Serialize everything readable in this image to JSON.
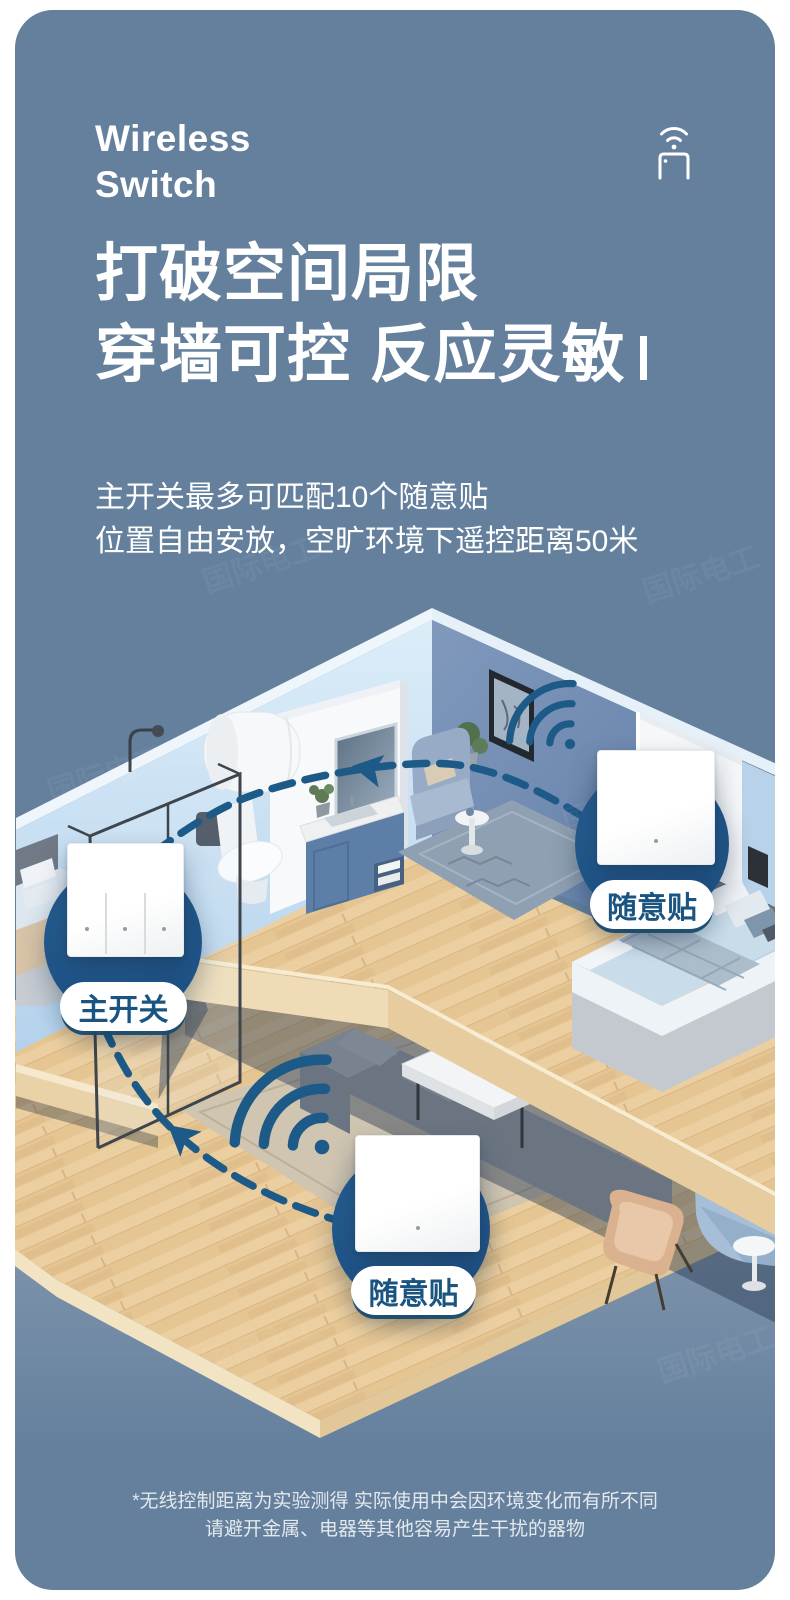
{
  "header": {
    "brand_line1": "Wireless",
    "brand_line2": "Switch"
  },
  "hero": {
    "title_line1": "打破空间局限",
    "title_line2": "穿墙可控 反应灵敏",
    "subtitle_line1": "主开关最多可匹配10个随意贴",
    "subtitle_line2": "位置自由安放，空旷环境下遥控距离50米"
  },
  "diagram": {
    "callouts": [
      {
        "id": "main-switch",
        "label": "主开关",
        "gangs": 3
      },
      {
        "id": "sticker-right",
        "label": "随意贴",
        "gangs": 1
      },
      {
        "id": "sticker-bottom",
        "label": "随意贴",
        "gangs": 1
      }
    ]
  },
  "footnote": {
    "line1": "*无线控制距离为实验测得 实际使用中会因环境变化而有所不同",
    "line2": "请避开金属、电器等其他容易产生干扰的器物"
  },
  "watermark": {
    "text": "国际电工"
  },
  "colors": {
    "card_background": "#64809d",
    "accent_dark_blue": "#1d5a88",
    "callout_circle": "#21568a",
    "label_text": "#1a5480",
    "wood": "#ebcfa0",
    "wall_light_blue": "#c9e0f3",
    "wall_steel_blue": "#6f8ab0"
  }
}
